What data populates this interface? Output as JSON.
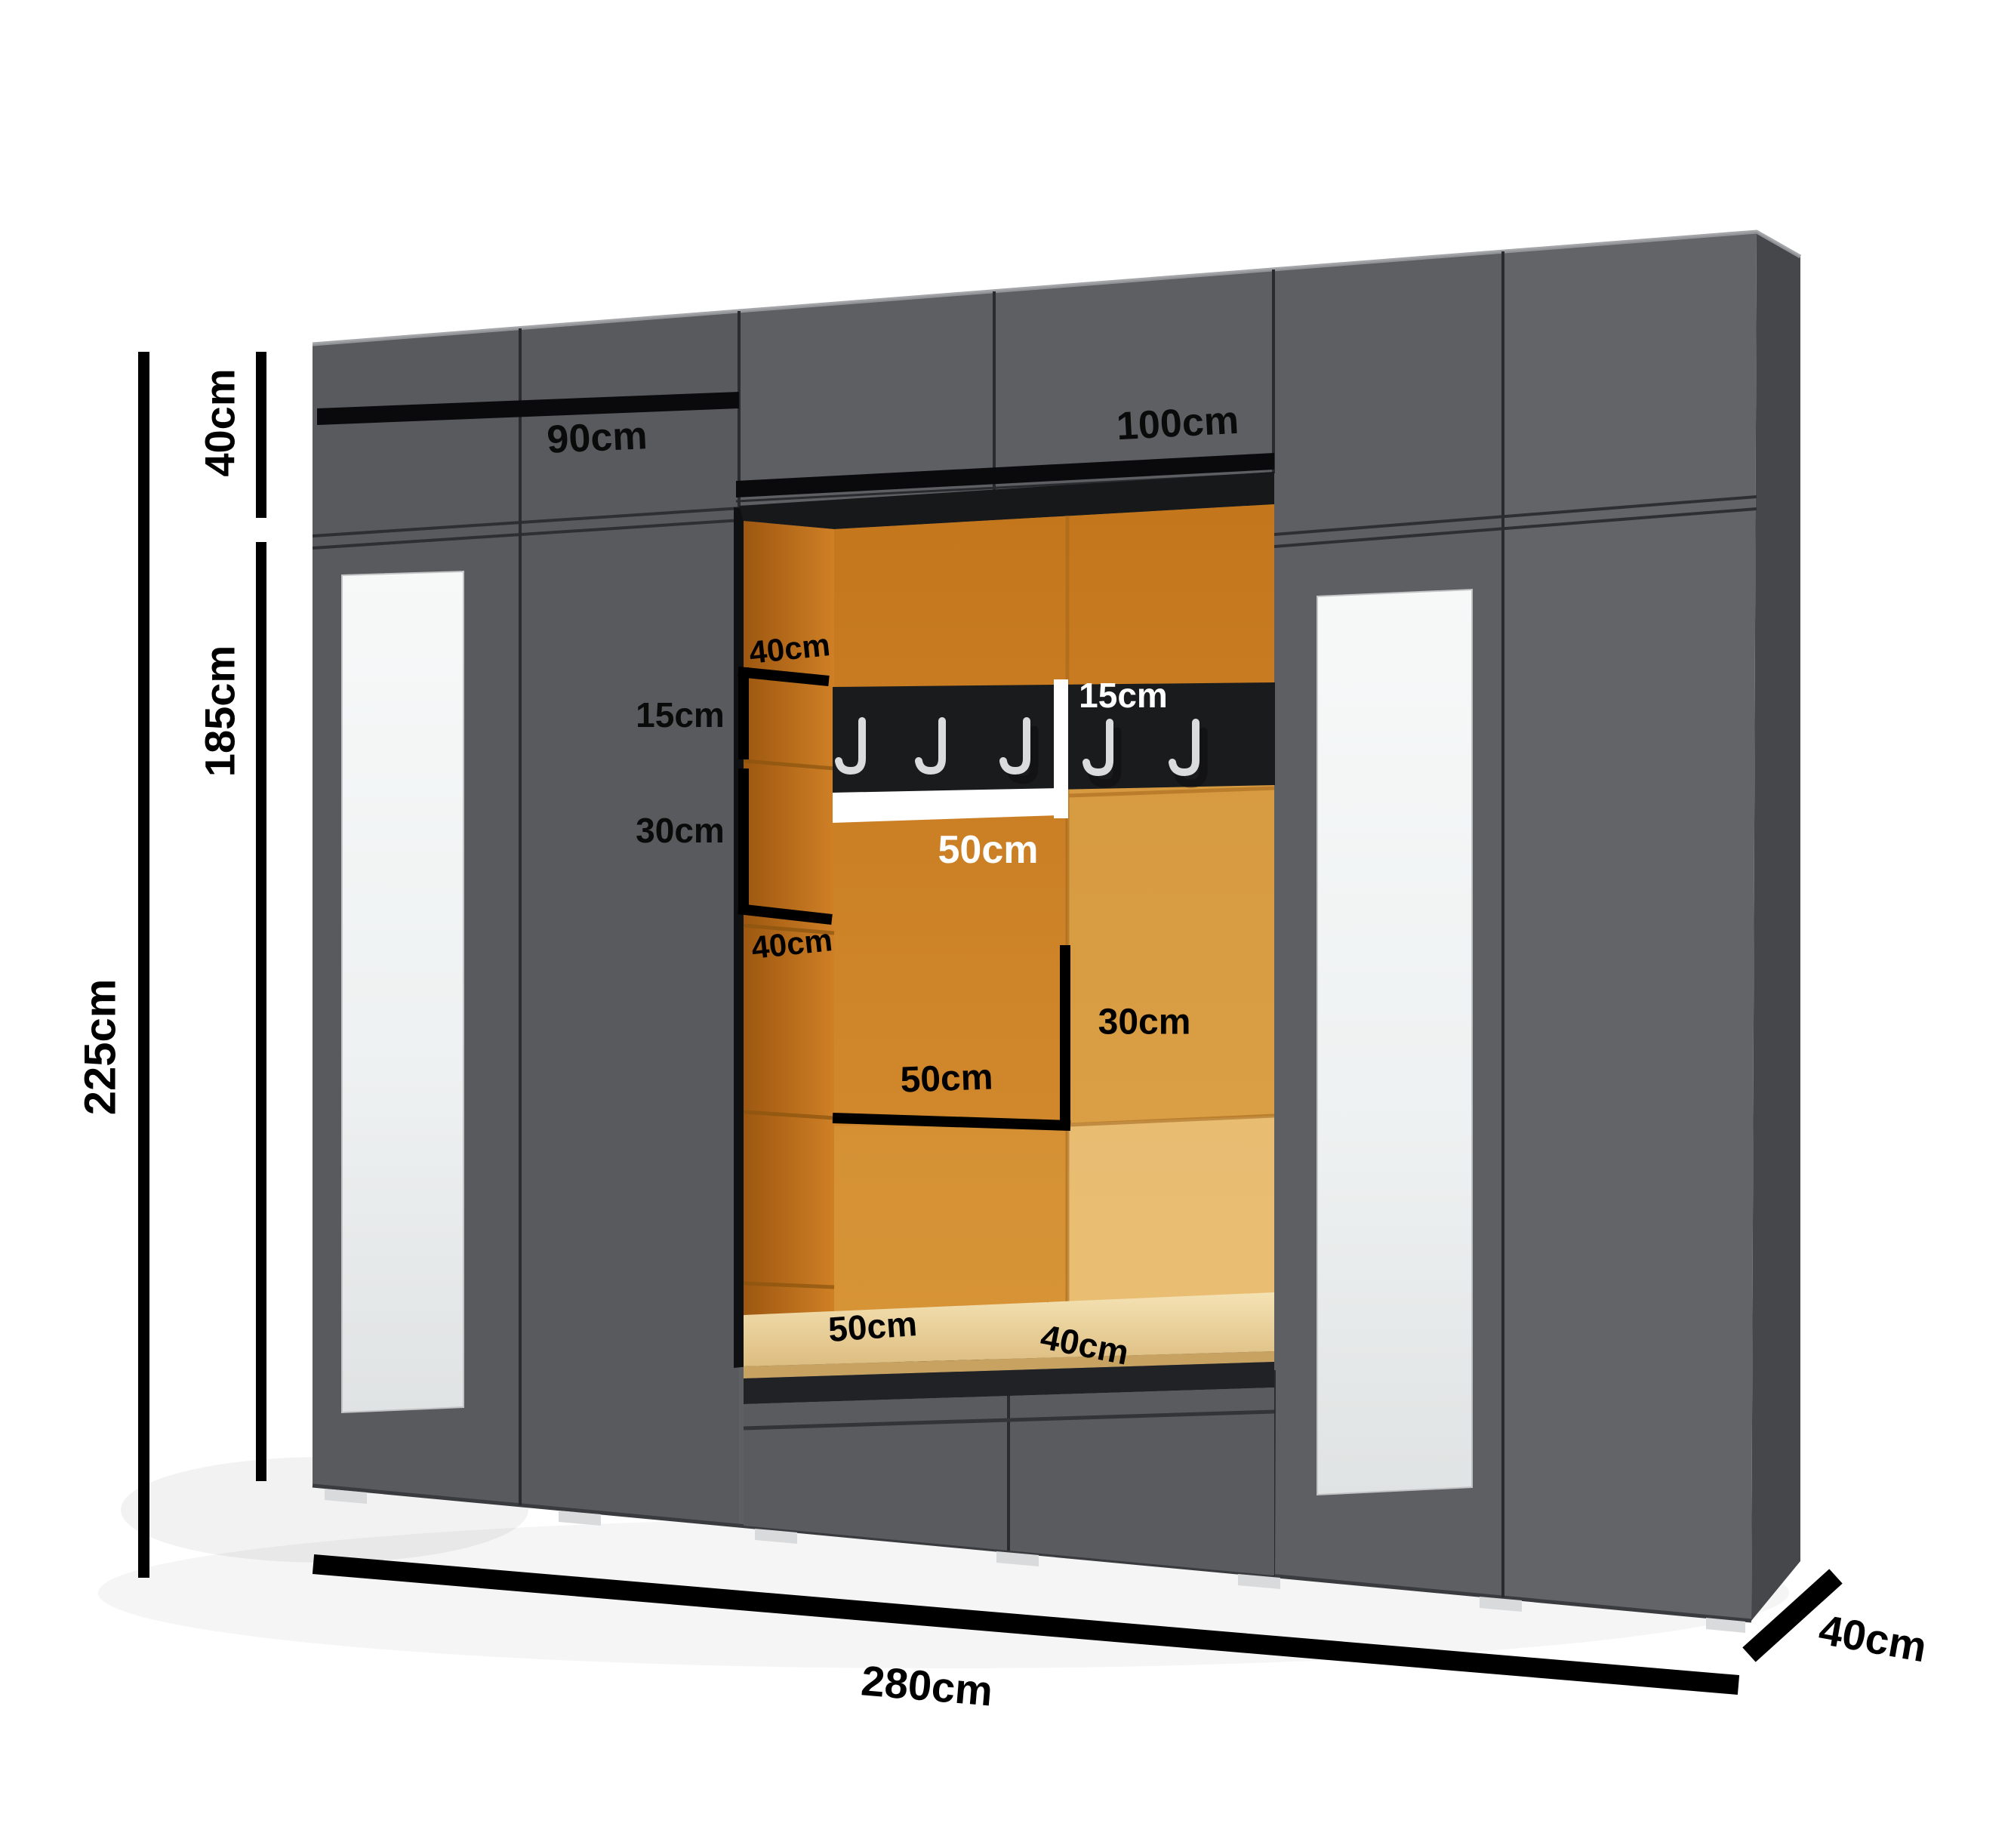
{
  "diagram": {
    "type": "furniture-dimension-diagram",
    "subject": "hallway wardrobe wall unit with upholstered niche, coat rail and bench"
  },
  "labels": {
    "total_height": "225cm",
    "top_cabinet_height": "40cm",
    "body_height": "185cm",
    "left_section_width": "90cm",
    "center_section_width": "100cm",
    "total_width": "280cm",
    "cabinet_depth": "40cm",
    "niche_side_depth_top": "40cm",
    "rail_offset_left": "15cm",
    "panel_gap_left": "30cm",
    "niche_side_depth_bottom": "40cm",
    "rail_height": "15cm",
    "rail_section_width": "50cm",
    "shelf_width": "50cm",
    "shelf_height": "30cm",
    "bench_width": "50cm",
    "bench_depth": "40cm"
  },
  "hooks": {
    "count": 5
  },
  "colors": {
    "cabinet_front": "#5e5f63",
    "cabinet_side": "#46474b",
    "groove_black": "#0a0a0c",
    "upholstery_dark": "#a35c12",
    "upholstery_main": "#c97e21",
    "upholstery_light": "#ecc67e",
    "bench_cushion": "#eed7a4",
    "rail_black": "#1a1b1d",
    "hook_silver": "#d9dbdd",
    "mirror_white": "#f5f7f7",
    "dimension_black": "#000000",
    "background": "#ffffff"
  }
}
